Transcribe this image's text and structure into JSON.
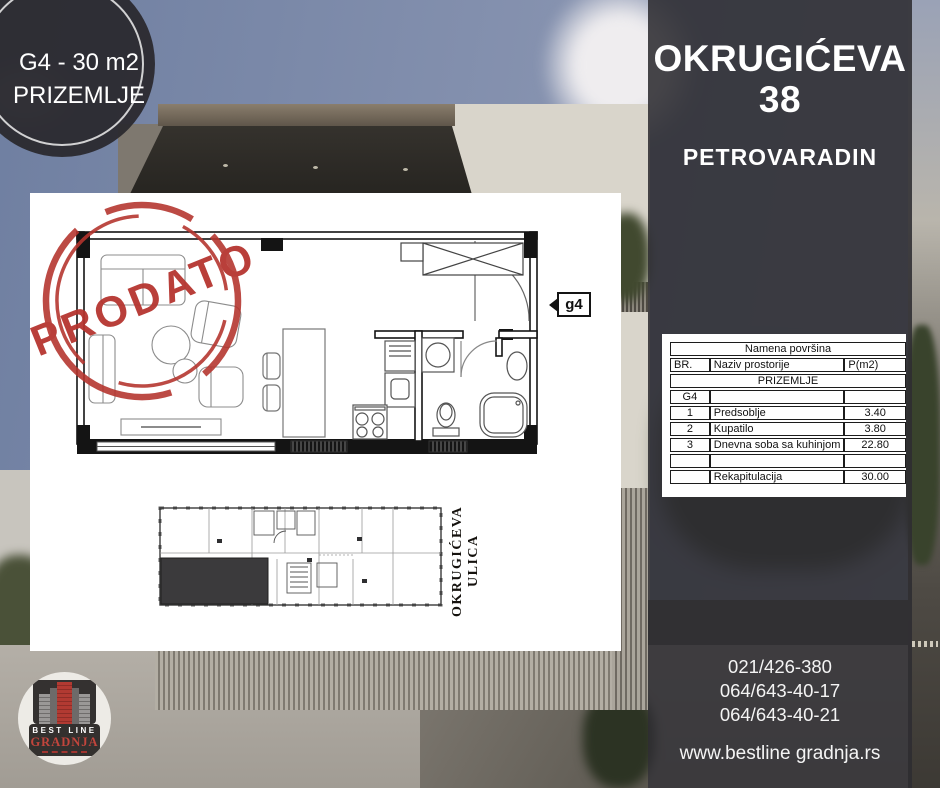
{
  "badge": {
    "unit": "G4 - 30 m2",
    "floor": "PRIZEMLJE"
  },
  "panel": {
    "title_line1": "OKRUGIĆEVA",
    "title_line2": "38",
    "subtitle": "PETROVARADIN",
    "phones": [
      "021/426-380",
      "064/643-40-17",
      "064/643-40-21"
    ],
    "website": "www.bestline gradnja.rs"
  },
  "area_table": {
    "title": "Namena površina",
    "columns": [
      "BR.",
      "Naziv prostorije",
      "P(m2)"
    ],
    "section": "PRIZEMLJE",
    "group": "G4",
    "rows": [
      {
        "br": "1",
        "name": "Predsoblje",
        "area": "3.40"
      },
      {
        "br": "2",
        "name": "Kupatilo",
        "area": "3.80"
      },
      {
        "br": "3",
        "name": "Dnevna soba sa kuhinjom",
        "area": "22.80"
      }
    ],
    "recap_label": "Rekapitulacija",
    "recap_total": "30.00"
  },
  "floor_plan": {
    "stamp": "PRODATO",
    "unit_tag": "g4",
    "street": "OKRUGIĆEVA ULICA"
  },
  "logo": {
    "line1": "BEST LINE",
    "line2": "GRADNJA"
  },
  "colors": {
    "stamp_red": "#b5342e",
    "logo_red": "#bf3b31",
    "panel_bg": "rgba(45,44,49,0.88)",
    "sheet_bg": "#ffffff",
    "sold_unit_fill": "#3b3a3c"
  }
}
